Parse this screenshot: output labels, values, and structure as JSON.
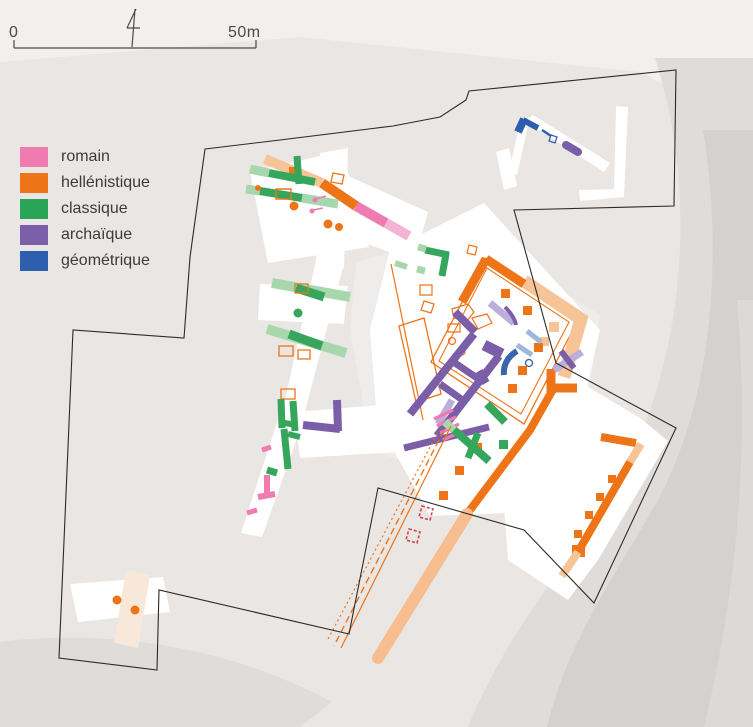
{
  "colors": {
    "romain": "#ef7bb0",
    "hellenistique": "#ee7418",
    "classique": "#2aa558",
    "archaique": "#7a5fa8",
    "geometrique": "#2e5fae",
    "rom": "#ef7bb0",
    "romL": "#f5b3d4",
    "hel": "#ee7418",
    "helL": "#f6c496",
    "cla": "#35a65c",
    "claL": "#a8d7ae",
    "arc": "#7a5fa8",
    "arcL": "#bcaeda",
    "geo": "#2e5fae",
    "geoL": "#9db8dc",
    "road": "#f7bd8e",
    "blue2": "#3c63b0",
    "red": "#d84050",
    "ink": "#4a4a48",
    "boundary": "#2b2b29",
    "bgLight": "#f2f0ee",
    "band1": "#dfdcd9",
    "band2": "#d4d1ce",
    "band3": "#dcd9d6",
    "white": "#ffffff",
    "dim": "#efedeb",
    "beige": "#f8e8d9"
  },
  "legend": {
    "items": [
      {
        "key": "romain",
        "label": "romain"
      },
      {
        "key": "hellenistique",
        "label": "hellénistique"
      },
      {
        "key": "classique",
        "label": "classique"
      },
      {
        "key": "archaique",
        "label": "archaïque"
      },
      {
        "key": "geometrique",
        "label": "géométrique"
      }
    ]
  },
  "scalebar": {
    "left_label": "0",
    "right_label": "50m"
  },
  "map": {
    "underlays": [
      {
        "d": "M0,0 L753,0 L753,130 L640,72 L300,37 L0,62 Z",
        "f": "bgLight"
      },
      {
        "d": "M655,58 C688,160 694,300 642,432 C600,535 520,600 468,727 L753,727 L753,58 Z",
        "f": "band1"
      },
      {
        "d": "M703,130 C724,260 712,400 657,502 C617,572 567,642 547,727 L753,727 L753,130 Z",
        "f": "band2"
      },
      {
        "d": "M737,300 C748,430 742,570 704,727 L753,727 L753,300 Z",
        "f": "band3"
      },
      {
        "d": "M0,642 C120,627 240,652 332,702 L300,727 L0,727 Z",
        "f": "band1"
      },
      {
        "d": "M356,262 L398,250 L422,300 L402,460 L372,452 L350,330 Z",
        "f": "dim"
      },
      {
        "d": "M520,265 L600,315 L588,400 L540,382 L505,300 Z",
        "f": "dim"
      }
    ],
    "excavations": [
      {
        "d": "M250,172 L342,151 L369,247 L268,263 Z",
        "f": "white"
      },
      {
        "d": "M320,153 L348,148 L344,268 L316,266 Z",
        "f": "white"
      },
      {
        "d": "M326,166 L428,212 L414,262 L312,222 Z",
        "f": "white"
      },
      {
        "d": "M316,260 L344,264 L300,430 L262,537 L241,533 L286,395 Z",
        "f": "white"
      },
      {
        "d": "M260,284 L348,286 L344,324 L258,320 Z",
        "f": "white"
      },
      {
        "d": "M390,250 L484,203 L600,330 L584,400 L536,512 L430,516 L377,420 L370,330 Z",
        "f": "white"
      },
      {
        "d": "M294,412 L392,404 L398,452 L300,458 Z",
        "f": "white"
      },
      {
        "d": "M528,392 L560,370 L640,418 L668,441 L598,560 L568,600 L508,560 L502,480 Z",
        "f": "white"
      },
      {
        "d": "M509,172 L521,118 L529,121 L517,175 Z",
        "f": "white"
      },
      {
        "d": "M525,121 L533,115 L610,163 L604,172 Z",
        "f": "white"
      },
      {
        "d": "M616,106 L628,107 L624,197 L580,201 L579,190 L614,189 Z",
        "f": "white"
      },
      {
        "d": "M496,152 L509,148 L517,186 L504,190 Z",
        "f": "white"
      },
      {
        "d": "M70,584 L163,577 L170,612 L78,622 Z",
        "f": "white"
      },
      {
        "d": "M126,570 L150,575 L138,648 L114,643 Z",
        "f": "beige"
      }
    ],
    "features": [
      {
        "d": "M265,159 L322,183",
        "s": "helL",
        "w": 10
      },
      {
        "d": "M322,183 L356,206",
        "s": "hel",
        "w": 10
      },
      {
        "d": "M356,206 L386,223",
        "s": "rom",
        "w": 10
      },
      {
        "d": "M386,223 L409,236",
        "s": "romL",
        "w": 10
      },
      {
        "d": "M289,167 h12 v11 h-12 Z",
        "f": "hel"
      },
      {
        "d": "M250,169 L269,173",
        "s": "claL",
        "w": 9
      },
      {
        "d": "M269,173 L315,182",
        "s": "cla",
        "w": 8
      },
      {
        "d": "M297,156 L299,184",
        "s": "cla",
        "w": 7
      },
      {
        "d": "M246,189 L260,191",
        "s": "claL",
        "w": 9
      },
      {
        "d": "M260,191 L302,198",
        "s": "cla",
        "w": 8
      },
      {
        "d": "M302,198 L338,204",
        "s": "claL",
        "w": 9
      },
      {
        "d": "M276,189 h15 v10 h-15 Z",
        "s": "hel",
        "w": 1.4
      },
      {
        "d": "M333,173 l11,2 -2,9 -11,-2 Z",
        "s": "hel",
        "w": 1.3
      },
      {
        "d": "M316,199 l10,-3",
        "s": "rom",
        "w": 1.5
      },
      {
        "c": [
          315,
          200,
          2.5
        ],
        "f": "rom"
      },
      {
        "d": "M313,210 l10,-2",
        "s": "rom",
        "w": 1.5
      },
      {
        "c": [
          312,
          211,
          2.5
        ],
        "f": "rom"
      },
      {
        "c": [
          294,
          206,
          4.5
        ],
        "f": "hel"
      },
      {
        "c": [
          328,
          224,
          4.5
        ],
        "f": "hel"
      },
      {
        "c": [
          339,
          227,
          4
        ],
        "f": "hel"
      },
      {
        "c": [
          258,
          188,
          3
        ],
        "f": "hel"
      },
      {
        "d": "M272,283 L350,297",
        "s": "claL",
        "w": 10
      },
      {
        "d": "M296,288 L324,297",
        "s": "cla",
        "w": 9
      },
      {
        "c": [
          298,
          313,
          4.5
        ],
        "f": "cla"
      },
      {
        "d": "M267,329 L346,353",
        "s": "claL",
        "w": 10
      },
      {
        "d": "M289,334 L322,346",
        "s": "cla",
        "w": 9
      },
      {
        "d": "M295,284 h13 v9 h-13 Z",
        "s": "hel",
        "w": 1.3
      },
      {
        "d": "M279,346 h14 v10 h-14 Z",
        "s": "hel",
        "w": 1.3
      },
      {
        "d": "M298,350 h12 v9 h-12 Z",
        "s": "hel",
        "w": 1.3
      },
      {
        "d": "M281,389 h14 v10 h-14 Z",
        "s": "hel",
        "w": 1.3
      },
      {
        "d": "M281,399 L282,428",
        "s": "cla",
        "w": 7
      },
      {
        "d": "M293,401 L295,431",
        "s": "cla",
        "w": 7
      },
      {
        "d": "M279,422 L296,425",
        "s": "cla",
        "w": 6
      },
      {
        "d": "M284,429 L288,469",
        "s": "cla",
        "w": 7
      },
      {
        "d": "M288,434 L300,437",
        "s": "cla",
        "w": 6
      },
      {
        "d": "M267,470 L277,473",
        "s": "cla",
        "w": 7
      },
      {
        "d": "M262,450 L271,447",
        "s": "rom",
        "w": 5
      },
      {
        "d": "M267,475 L267,495",
        "s": "rom",
        "w": 6
      },
      {
        "d": "M258,497 L275,494",
        "s": "rom",
        "w": 6
      },
      {
        "d": "M247,513 L257,510",
        "s": "rom",
        "w": 5
      },
      {
        "d": "M395,263 L407,267",
        "s": "claL",
        "w": 6
      },
      {
        "d": "M485,258 L578,320 L524,424 L431,362 Z",
        "s": "hel",
        "w": 1.3
      },
      {
        "d": "M487,268 L569,322 L521,414 L439,361 Z",
        "s": "hel",
        "w": 1.1
      },
      {
        "d": "M399,326 L424,318 L441,394 L416,402 Z",
        "s": "hel",
        "w": 1.3
      },
      {
        "d": "M391,264 L423,420",
        "s": "hel",
        "w": 1.2
      },
      {
        "d": "M469,245 l8,2 -2,8 -8,-2 Z",
        "s": "hel",
        "w": 1.2
      },
      {
        "d": "M420,285 h12 v10 h-12 Z",
        "s": "hel",
        "w": 1.2
      },
      {
        "d": "M424,301 l10,3 -3,9 -10,-3 Z",
        "s": "hel",
        "w": 1.2
      },
      {
        "d": "M452,309 l16,-5 6,8 -7,9 -13,-3 Z",
        "s": "hel",
        "w": 1.2
      },
      {
        "d": "M472,318 l15,-4 5,9 -14,6 Z",
        "s": "hel",
        "w": 1.2
      },
      {
        "d": "M448,324 h12 v8 h-12 Z",
        "s": "hel",
        "w": 1.2
      },
      {
        "c": [
          452,
          341,
          3.5
        ],
        "s": "hel",
        "w": 1.2
      },
      {
        "c": [
          462,
          352,
          3
        ],
        "s": "hel",
        "w": 1.2
      },
      {
        "d": "M524,281 L581,319 L564,377",
        "s": "helL",
        "w": 13
      },
      {
        "d": "M549,322 h10 v10 h-10 Z",
        "f": "helL"
      },
      {
        "d": "M540,337 h9 v9 h-9 Z",
        "f": "helL"
      },
      {
        "d": "M486,259 L462,302",
        "s": "hel",
        "w": 9
      },
      {
        "d": "M486,259 L524,284",
        "s": "hel",
        "w": 9
      },
      {
        "d": "M551,369 L551,392",
        "s": "hel",
        "w": 9
      },
      {
        "d": "M548,388 L577,388",
        "s": "hel",
        "w": 9
      },
      {
        "d": "M556,384 L530,430 L467,514",
        "s": "hel",
        "w": 8
      },
      {
        "d": "M467,514 L378,658",
        "s": "road",
        "w": 12,
        "cap": "round"
      },
      {
        "d": "M501,289 h9 v9 h-9 Z",
        "f": "hel"
      },
      {
        "d": "M523,306 h9 v9 h-9 Z",
        "f": "hel"
      },
      {
        "d": "M534,343 h9 v9 h-9 Z",
        "f": "hel"
      },
      {
        "d": "M518,366 h9 v9 h-9 Z",
        "f": "hel"
      },
      {
        "d": "M508,384 h9 v9 h-9 Z",
        "f": "hel"
      },
      {
        "d": "M473,443 h9 v9 h-9 Z",
        "f": "hel"
      },
      {
        "d": "M455,466 h9 v9 h-9 Z",
        "f": "hel"
      },
      {
        "d": "M439,491 h9 v9 h-9 Z",
        "f": "hel"
      },
      {
        "d": "M474,334 L410,414",
        "s": "arc",
        "w": 8
      },
      {
        "d": "M499,356 L437,436",
        "s": "arc",
        "w": 8
      },
      {
        "d": "M455,312 L475,332",
        "s": "arc",
        "w": 8
      },
      {
        "d": "M484,345 L502,354",
        "s": "arc",
        "w": 11
      },
      {
        "d": "M452,361 L477,378",
        "s": "arc",
        "w": 7
      },
      {
        "d": "M479,371 L486,383",
        "s": "arc",
        "w": 8
      },
      {
        "d": "M440,384 L464,401",
        "s": "arc",
        "w": 7
      },
      {
        "d": "M490,303 L514,323",
        "s": "arcL",
        "w": 7
      },
      {
        "d": "M505,307 C511,313 515,319 516,325",
        "s": "arc",
        "w": 4
      },
      {
        "d": "M452,400 L438,424",
        "s": "arcL",
        "w": 7
      },
      {
        "d": "M554,370 L582,352",
        "s": "arcL",
        "w": 7
      },
      {
        "d": "M561,351 L574,368",
        "s": "arc",
        "w": 6
      },
      {
        "d": "M303,425 L340,429",
        "s": "arc",
        "w": 8
      },
      {
        "d": "M337,400 L338,431",
        "s": "arc",
        "w": 8
      },
      {
        "d": "M404,448 L489,427",
        "s": "arc",
        "w": 7
      },
      {
        "d": "M566,145 L578,152",
        "s": "arc",
        "w": 8,
        "cap": "round"
      },
      {
        "d": "M434,419 L453,410 M437,426 L456,417 M440,433 L459,424 M443,440 L462,431",
        "s": "rom",
        "w": 3.2
      },
      {
        "d": "M518,132 L524,119",
        "s": "geo",
        "w": 8
      },
      {
        "d": "M523,120 L538,128",
        "s": "geo",
        "w": 6
      },
      {
        "d": "M542,130 L551,136",
        "s": "geo",
        "w": 2.5
      },
      {
        "d": "M551,135 l6,2 -2,6 -6,-2 Z",
        "s": "geo",
        "w": 1.2
      },
      {
        "d": "M517,351 C507,357 503,366 504,375",
        "s": "blue2",
        "w": 6
      },
      {
        "d": "M517,345 L532,355",
        "s": "geoL",
        "w": 5
      },
      {
        "d": "M527,331 L541,342",
        "s": "geoL",
        "w": 5
      },
      {
        "c": [
          529,
          363,
          3.5
        ],
        "s": "geo",
        "w": 1.3
      },
      {
        "d": "M425,250 L449,255",
        "s": "cla",
        "w": 7
      },
      {
        "d": "M446,254 L442,276",
        "s": "cla",
        "w": 7
      },
      {
        "d": "M418,247 L426,249",
        "s": "claL",
        "w": 7
      },
      {
        "d": "M417,269 L425,271",
        "s": "claL",
        "w": 7
      },
      {
        "d": "M453,429 L489,461",
        "s": "cla",
        "w": 8
      },
      {
        "d": "M478,433 L468,458",
        "s": "cla",
        "w": 7
      },
      {
        "d": "M487,404 L505,422",
        "s": "cla",
        "w": 8
      },
      {
        "d": "M499,440 h9 v9 h-9 Z",
        "f": "cla"
      },
      {
        "d": "M445,422 L454,430",
        "s": "claL",
        "w": 8
      },
      {
        "d": "M601,437 L636,443",
        "s": "hel",
        "w": 8
      },
      {
        "d": "M630,462 L578,552",
        "s": "hel",
        "w": 8
      },
      {
        "d": "M608,475 h8 v8 h-8 Z",
        "f": "hel"
      },
      {
        "d": "M596,493 h8 v8 h-8 Z",
        "f": "hel"
      },
      {
        "d": "M585,511 h8 v8 h-8 Z",
        "f": "hel"
      },
      {
        "d": "M574,530 h8 v8 h-8 Z",
        "f": "hel"
      },
      {
        "d": "M572,545 h13 v12 h-13 Z",
        "f": "hel"
      },
      {
        "d": "M578,552 L562,576",
        "s": "helL",
        "w": 8
      },
      {
        "d": "M630,462 L641,444",
        "s": "helL",
        "w": 8
      },
      {
        "d": "M451,426 L341,648",
        "s": "hel",
        "w": 1.2
      },
      {
        "d": "M444,430 L334,646",
        "s": "hel",
        "w": 1.4,
        "da": "7,4"
      },
      {
        "d": "M437,434 L327,641",
        "s": "hel",
        "w": 1.2,
        "da": "2,3"
      },
      {
        "d": "M422,506 l11,3 -3,11 -11,-3 Z",
        "s": "red",
        "w": 1.6,
        "da": "3,2"
      },
      {
        "d": "M409,529 l11,3 -3,11 -11,-3 Z",
        "s": "red",
        "w": 1.6,
        "da": "3,2"
      },
      {
        "c": [
          117,
          600,
          4.5
        ],
        "f": "hel"
      },
      {
        "c": [
          135,
          610,
          4.5
        ],
        "f": "hel"
      }
    ],
    "boundary": {
      "d": "M205,149 L280,140 L393,126 L440,117 L466,100 L469,91 L676,70 L674,206 L514,210 L556,363 L676,428 L594,603 L524,530 L378,488 L349,634 L159,590 L157,670 L59,658 L73,330 L184,338 L190,257 Z",
      "s": "boundary",
      "w": 1.1
    },
    "overlay": [
      {
        "d": "M14,48 L256,48 M14,48 L14,40 M256,48 L256,40",
        "s": "ink",
        "w": 1.2
      },
      {
        "d": "M135,9 L132,47 M136,9 L127,28 M127,28 L140,28",
        "s": "ink",
        "w": 1.2
      }
    ]
  }
}
